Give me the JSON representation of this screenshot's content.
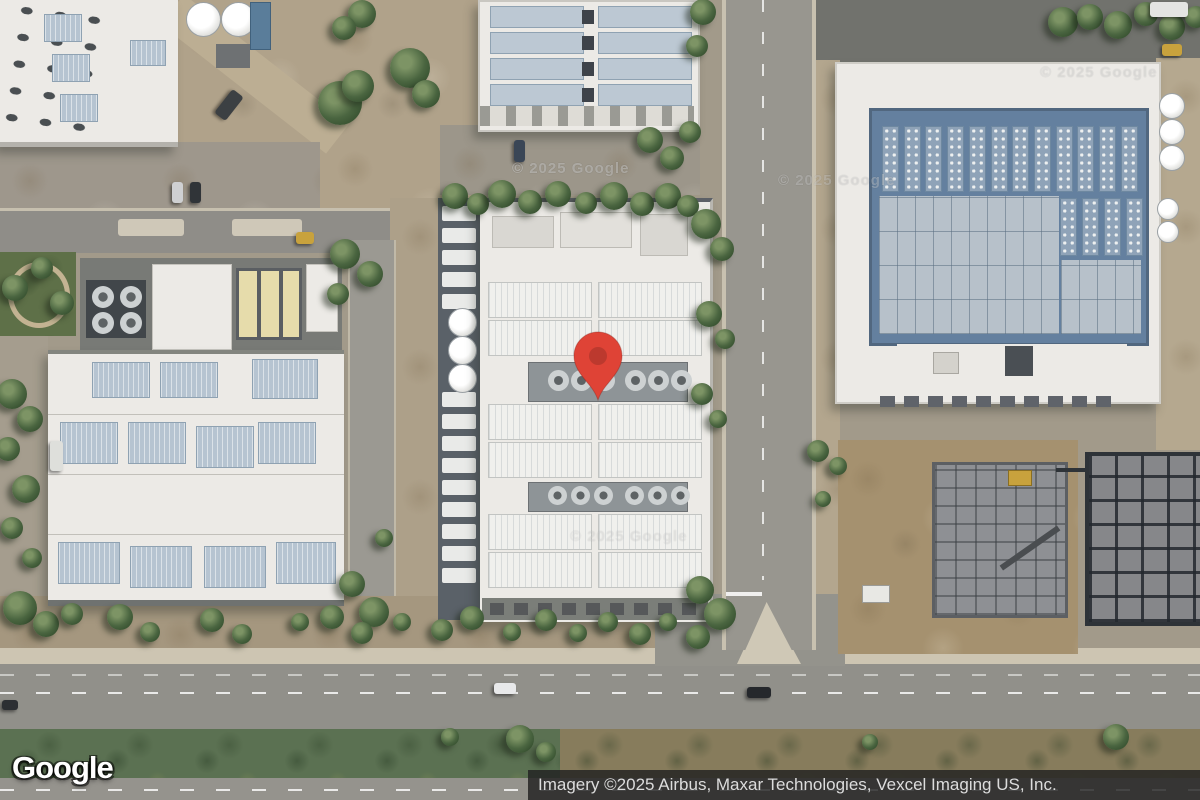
{
  "map": {
    "view_type": "satellite",
    "logo": "Google",
    "attribution": "Imagery ©2025 Airbus, Maxar Technologies, Vexcel Imaging US, Inc.",
    "watermark": "© 2025 Google",
    "marker": {
      "x": 598,
      "y": 400,
      "color": "#DF4336",
      "dot_color": "#BC392E"
    }
  },
  "colors": {
    "attr-bg": "rgba(33,33,33,0.82)",
    "attr-fg": "#dcdcdc",
    "ground": "#a29a8a",
    "asphalt": "#91908a",
    "roof-white": "#eceae6",
    "panel-blue": "#b6c4d1",
    "building-blue": "#64809f",
    "tree-green": "#4a6540",
    "median-green": "#5b7152",
    "dirt": "#a5916f"
  }
}
